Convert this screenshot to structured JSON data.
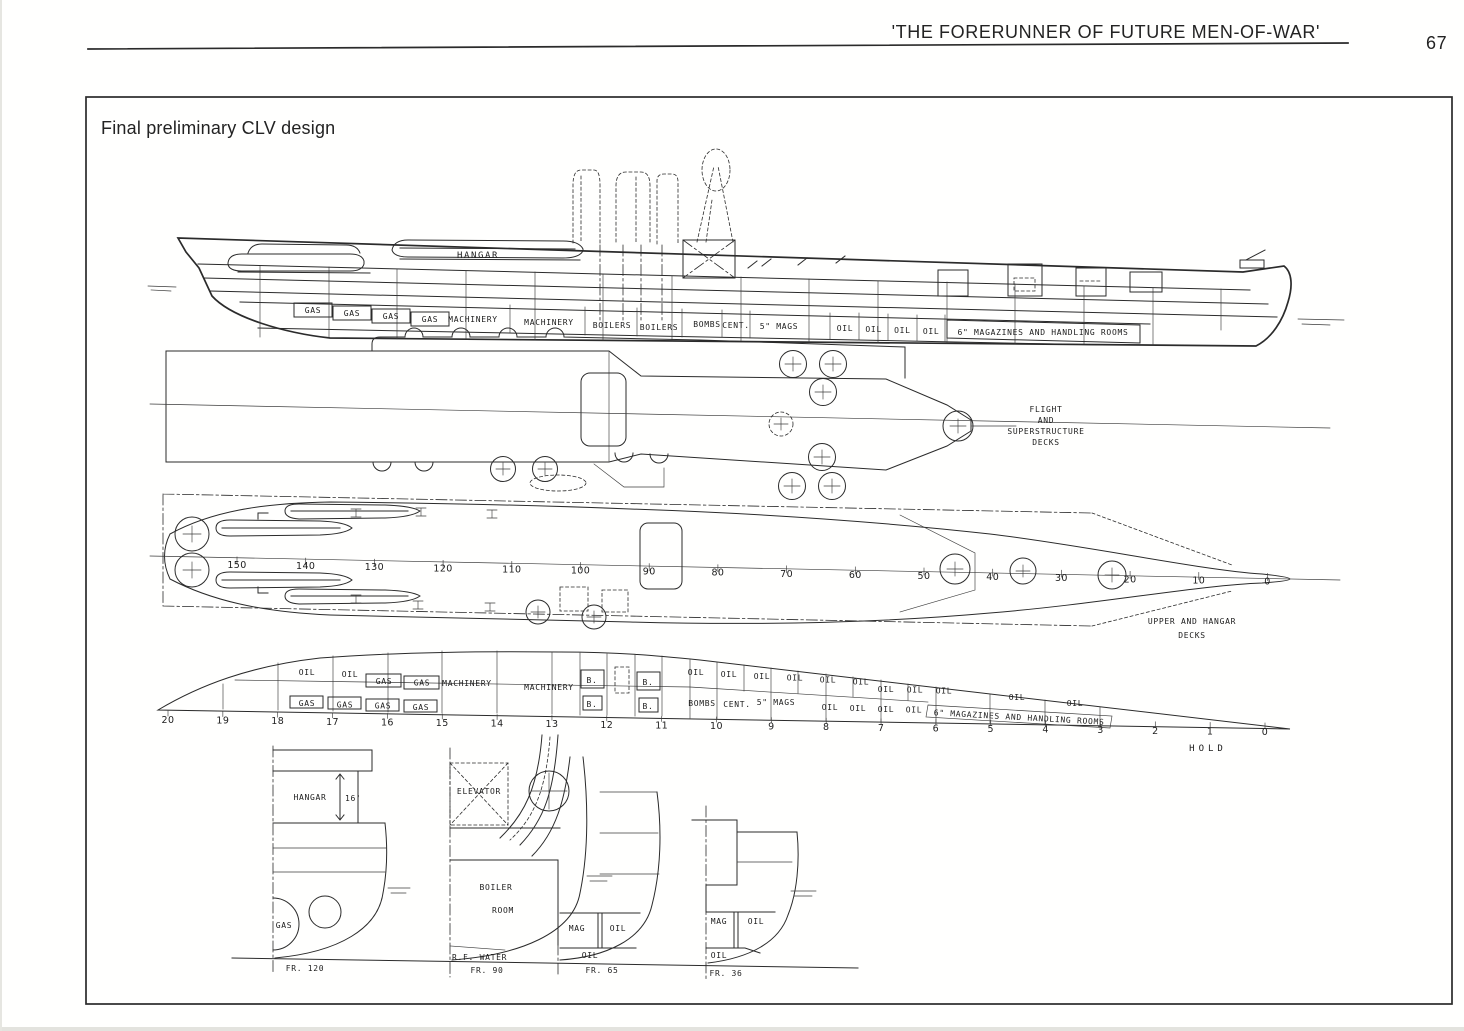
{
  "page": {
    "header_title": "'THE FORERUNNER OF FUTURE MEN-OF-WAR'",
    "page_number": "67",
    "caption": "Final preliminary CLV design"
  },
  "profile": {
    "hangar": "HANGAR",
    "gas": [
      "GAS",
      "GAS",
      "GAS",
      "GAS"
    ],
    "machinery_fwd": "MACHINERY",
    "machinery_aft": "MACHINERY",
    "boilers_1": "BOILERS",
    "boilers_2": "BOILERS",
    "bombs": "BOMBS",
    "cent": "CENT.",
    "five_in_mags": "5\" MAGS",
    "oil": [
      "OIL",
      "OIL",
      "OIL",
      "OIL"
    ],
    "six_in_mags": "6\" MAGAZINES AND HANDLING ROOMS"
  },
  "flight_deck": {
    "label": [
      "FLIGHT",
      "AND",
      "SUPERSTRUCTURE",
      "DECKS"
    ]
  },
  "upper_deck": {
    "frames": [
      "150",
      "140",
      "130",
      "120",
      "110",
      "100",
      "90",
      "80",
      "70",
      "60",
      "50",
      "40",
      "30",
      "20",
      "10",
      "0"
    ],
    "label": [
      "UPPER  AND  HANGAR",
      "DECKS"
    ]
  },
  "hold": {
    "oil_aft": [
      "OIL",
      "OIL"
    ],
    "gas_upper": [
      "GAS",
      "GAS"
    ],
    "gas_lower": [
      "GAS",
      "GAS",
      "GAS",
      "GAS"
    ],
    "machinery_1": "MACHINERY",
    "machinery_2": "MACHINERY",
    "b_upper": [
      "B.",
      "B."
    ],
    "b_lower": [
      "B.",
      "B."
    ],
    "oil_row1": [
      "OIL",
      "OIL",
      "OIL",
      "OIL",
      "OIL",
      "OIL"
    ],
    "oil_mid": [
      "OIL",
      "OIL",
      "OIL"
    ],
    "bombs": "BOMBS",
    "cent": "CENT.",
    "five_in_mags": "5\" MAGS",
    "oil_row2": [
      "OIL",
      "OIL",
      "OIL",
      "OIL"
    ],
    "oil_wide": [
      "OIL",
      "OIL"
    ],
    "six_in_mags": "6\" MAGAZINES AND HANDLING ROOMS",
    "frames": [
      "20",
      "19",
      "18",
      "17",
      "16",
      "15",
      "14",
      "13",
      "12",
      "11",
      "10",
      "9",
      "8",
      "7",
      "6",
      "5",
      "4",
      "3",
      "2",
      "1",
      "0"
    ],
    "label": "HOLD"
  },
  "sections": {
    "fr120": {
      "hangar": "HANGAR",
      "height": "16'",
      "gas": "GAS",
      "frame": "FR. 120"
    },
    "fr90": {
      "elevator": "ELEVATOR",
      "boiler_1": "BOILER",
      "boiler_2": "ROOM",
      "rf_water": "R.F. WATER",
      "frame": "FR. 90"
    },
    "fr65": {
      "mag": "MAG",
      "oil_1": "OIL",
      "oil_2": "OIL",
      "frame": "FR. 65"
    },
    "fr36": {
      "mag": "MAG",
      "oil_1": "OIL",
      "oil_2": "OIL",
      "frame": "FR. 36"
    }
  }
}
